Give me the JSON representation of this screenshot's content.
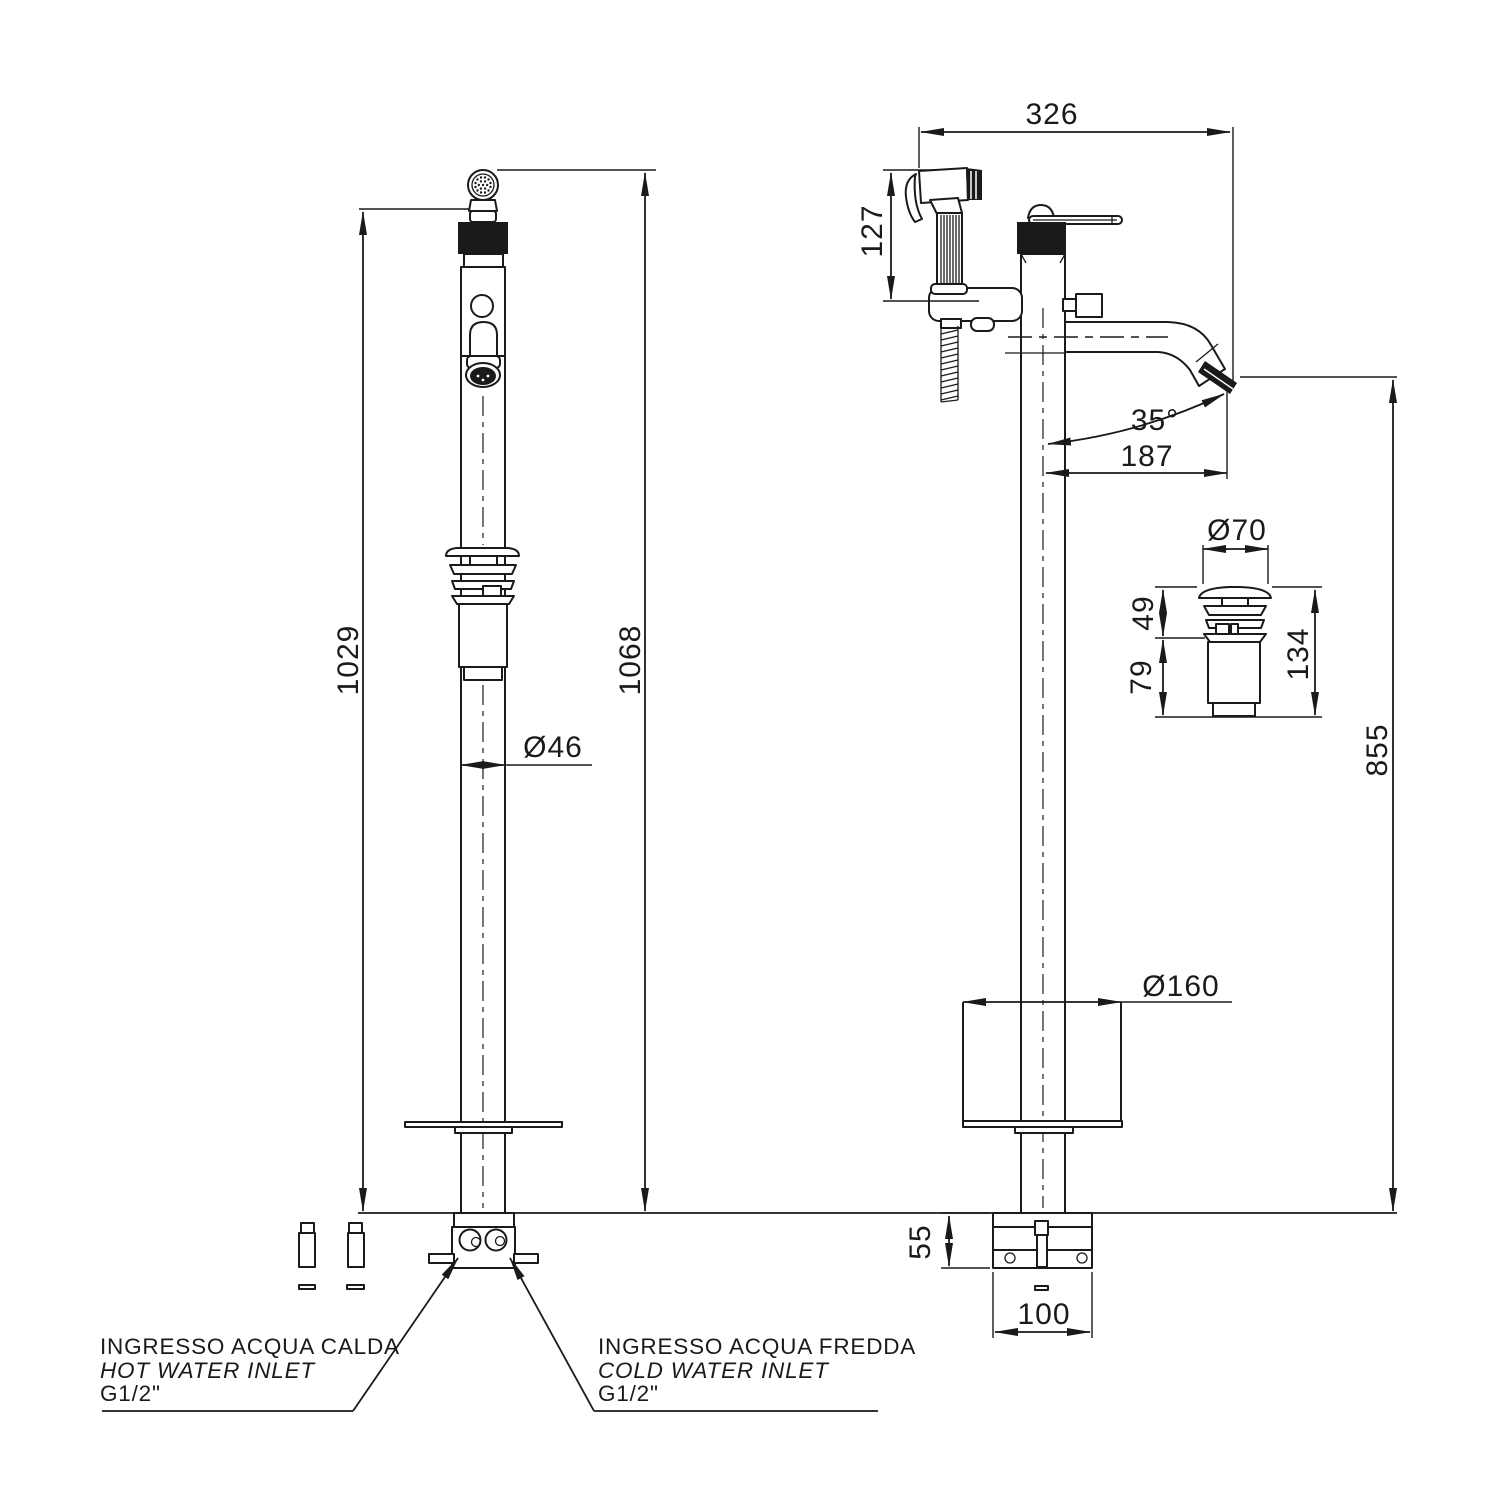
{
  "drawing": {
    "colors": {
      "line": "#1a1a1a",
      "background": "#ffffff"
    },
    "dims": {
      "d326": "326",
      "d127": "127",
      "d35": "35°",
      "d187": "187",
      "d855": "855",
      "d70": "Ø70",
      "d49": "49",
      "d79": "79",
      "d134": "134",
      "d160": "Ø160",
      "d55": "55",
      "d100": "100",
      "d1029": "1029",
      "d1068": "1068",
      "d46": "Ø46"
    },
    "labels": {
      "hot1": "INGRESSO ACQUA CALDA",
      "hot2": "HOT WATER INLET",
      "hot3": "G1/2\"",
      "cold1": "INGRESSO ACQUA FREDDA",
      "cold2": "COLD WATER INLET",
      "cold3": "G1/2\""
    }
  }
}
